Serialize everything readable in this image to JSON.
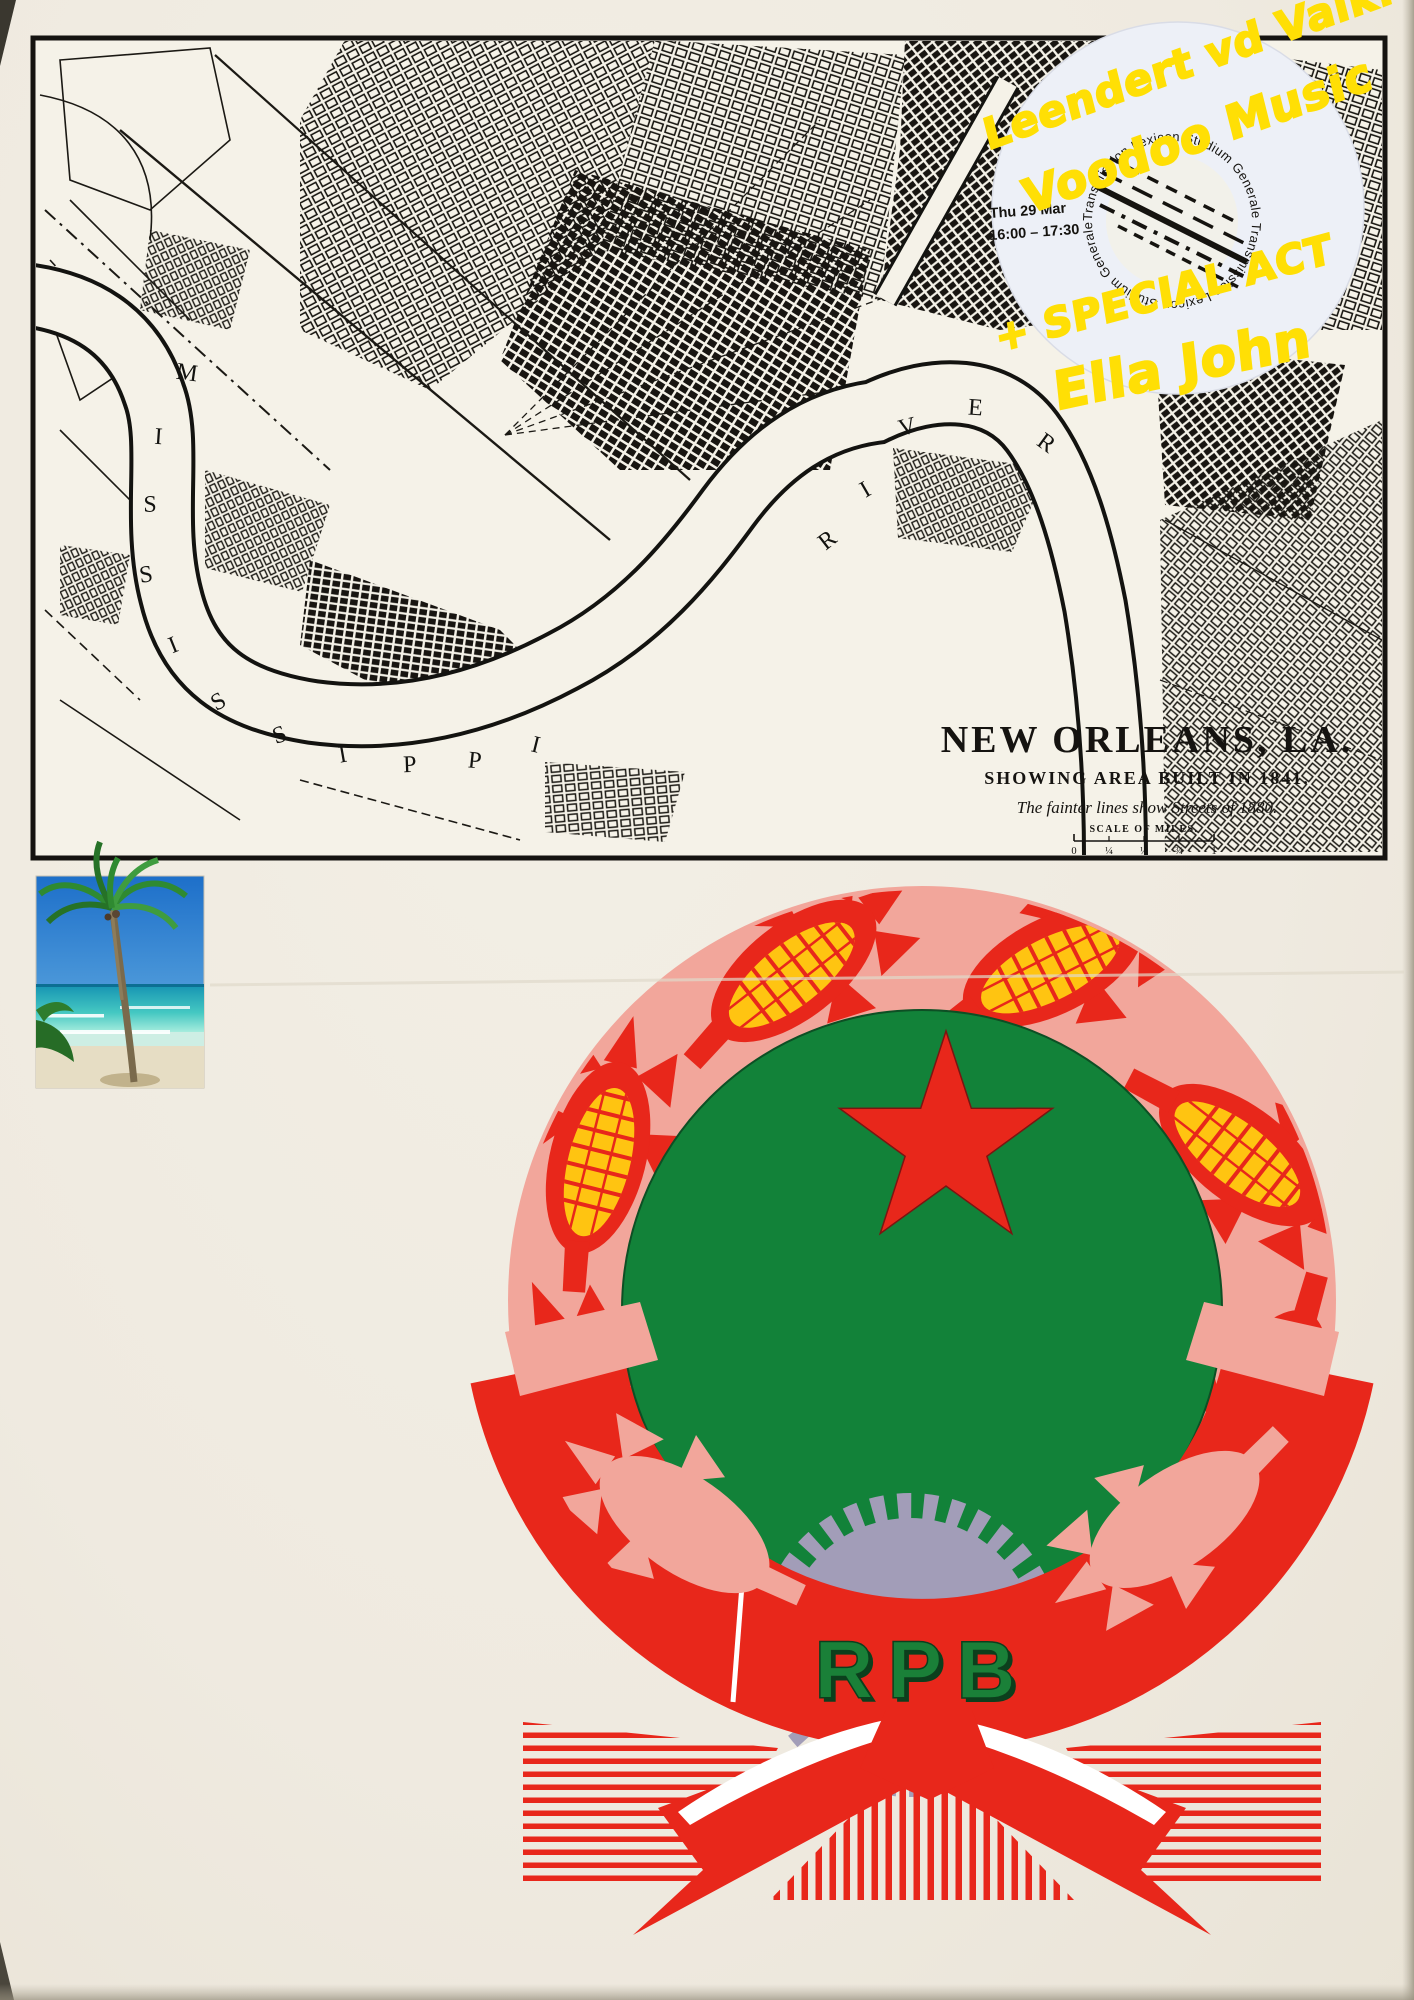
{
  "page": {
    "background_color": "#efeae0"
  },
  "map": {
    "title": "NEW ORLEANS, LA.",
    "subtitle": "SHOWING AREA BUILT IN 1841.",
    "note": "The fainter lines show Streets of 1880.",
    "scale_label": "SCALE OF MILES.",
    "scale_ticks": [
      "0",
      "¼",
      "½",
      "¾",
      "1"
    ],
    "ms": [
      "M",
      "I",
      "S",
      "S",
      "I",
      "S",
      "S",
      "I",
      "P",
      "P",
      "I"
    ],
    "rv": [
      "R",
      "I",
      "V",
      "E",
      "R"
    ]
  },
  "sticker": {
    "handwriting": {
      "line1": "Leendert vd Valk:",
      "line2": "Voodoo Music",
      "line3": "+ SPECIAL ACT",
      "line4": "Ella John"
    },
    "date": "Thu 29 Mar",
    "time": "16:00 – 17:30",
    "ring_text": "Transmission Lexicon Studium Generale Transmission Lexicon Studium Generale ",
    "marker_color": "#ffdf05"
  },
  "photo": {
    "description": "Palm tree on a tropical beach"
  },
  "emblem": {
    "initials": "RPB",
    "colors": {
      "pink": "#f2a69b",
      "red": "#e8271b",
      "yellow": "#ffc411",
      "green": "#128239",
      "gear_gray": "#a29db8",
      "letter_green": "#1a8038"
    }
  }
}
